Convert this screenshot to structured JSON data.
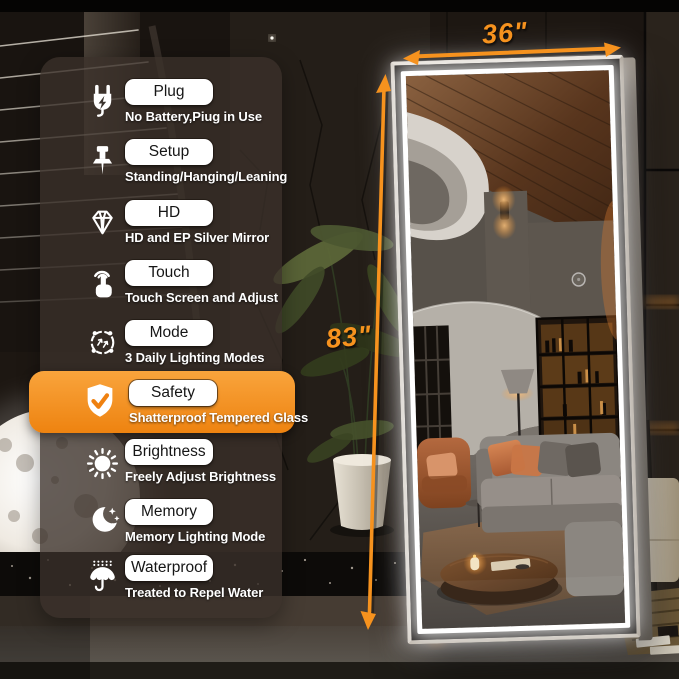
{
  "dimensions": {
    "width_label": "36\"",
    "height_label": "83\""
  },
  "features": [
    {
      "icon": "plug-icon",
      "label": "Plug",
      "description": "No Battery,Piug in Use",
      "highlighted": false
    },
    {
      "icon": "pushpin-icon",
      "label": "Setup",
      "description": "Standing/Hanging/Leaning",
      "highlighted": false
    },
    {
      "icon": "diamond-icon",
      "label": "HD",
      "description": "HD and EP Silver Mirror",
      "highlighted": false
    },
    {
      "icon": "touch-icon",
      "label": "Touch",
      "description": "Touch Screen and Adjust",
      "highlighted": false
    },
    {
      "icon": "lighting-mode-icon",
      "label": "Mode",
      "description": "3 Daily Lighting Modes",
      "highlighted": false
    },
    {
      "icon": "shield-check-icon",
      "label": "Safety",
      "description": "Shatterproof Tempered Glass",
      "highlighted": true
    },
    {
      "icon": "sun-icon",
      "label": "Brightness",
      "description": "Freely Adjust Brightness",
      "highlighted": false
    },
    {
      "icon": "moon-stars-icon",
      "label": "Memory",
      "description": "Memory Lighting Mode",
      "highlighted": false
    },
    {
      "icon": "umbrella-rain-icon",
      "label": "Waterproof",
      "description": "Treated to Repel Water",
      "highlighted": false
    }
  ],
  "colors": {
    "accent_orange": "#F6921E",
    "led_white": "#FFFFFF",
    "highlight_band": "#EF8B15"
  }
}
